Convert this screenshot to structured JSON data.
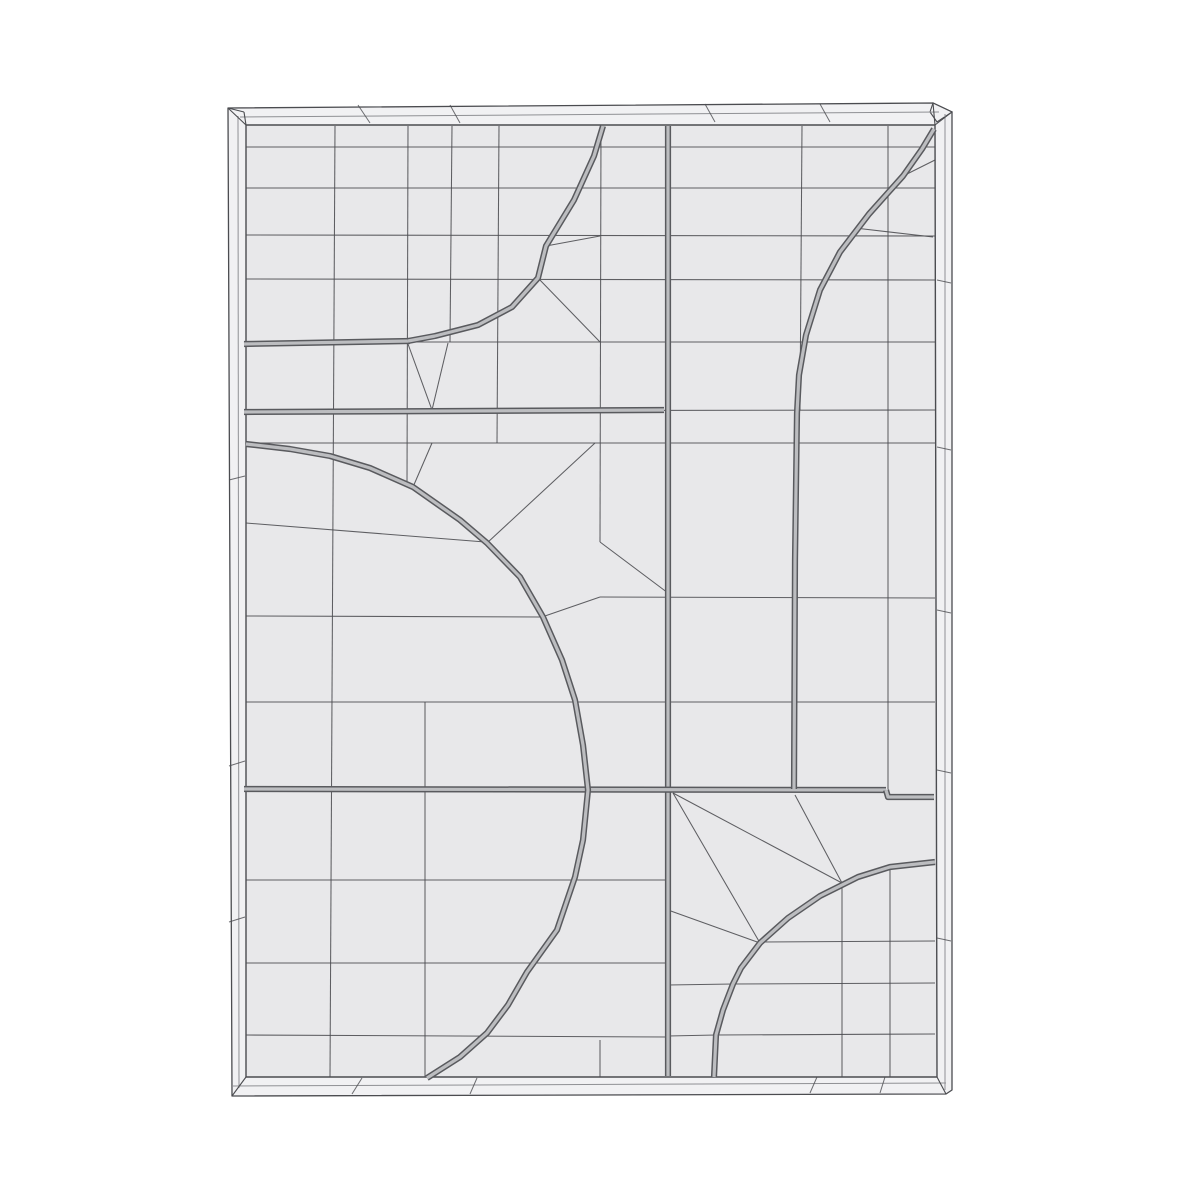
{
  "canvas": {
    "width": 1200,
    "height": 1200,
    "background": "#ffffff"
  },
  "colors": {
    "face_fill": "#e8e8ea",
    "band_fill": "#f1f1f3",
    "line": "#4b4c50",
    "band_line": "#8f9094",
    "groove_dark": "#595a5e",
    "groove_light": "#bcbdc0"
  },
  "panel": {
    "outer_polygon": [
      [
        228,
        108
      ],
      [
        933,
        103
      ],
      [
        952,
        112
      ],
      [
        952,
        1090
      ],
      [
        946,
        1094
      ],
      [
        232,
        1096
      ]
    ],
    "corner_lip": [
      [
        933,
        103
      ],
      [
        952,
        112
      ],
      [
        937,
        122
      ],
      [
        930,
        112
      ]
    ],
    "inner_polygon": [
      [
        246,
        125
      ],
      [
        935,
        125
      ],
      [
        937,
        1077
      ],
      [
        246,
        1077
      ]
    ],
    "band_mid_lines": [
      [
        240,
        117,
        939,
        112
      ],
      [
        238,
        116,
        239,
        1088
      ],
      [
        233,
        1086,
        946,
        1083
      ],
      [
        945,
        114,
        945,
        1090
      ]
    ],
    "corner_bevels": [
      [
        228,
        108,
        246,
        125
      ],
      [
        933,
        103,
        935,
        125
      ],
      [
        952,
        112,
        935,
        125
      ],
      [
        232,
        1096,
        246,
        1077
      ],
      [
        946,
        1094,
        937,
        1077
      ],
      [
        228,
        108,
        244,
        112
      ],
      [
        244,
        112,
        246,
        125
      ]
    ],
    "band_ticks": [
      [
        358,
        105,
        370,
        123
      ],
      [
        450,
        105,
        460,
        123
      ],
      [
        705,
        104,
        715,
        122
      ],
      [
        820,
        104,
        830,
        122
      ],
      [
        362,
        1078,
        352,
        1094
      ],
      [
        477,
        1078,
        470,
        1094
      ],
      [
        817,
        1077,
        810,
        1093
      ],
      [
        885,
        1077,
        880,
        1093
      ],
      [
        229,
        480,
        245,
        476
      ],
      [
        229,
        766,
        245,
        761
      ],
      [
        229,
        922,
        245,
        917
      ],
      [
        937,
        280,
        951,
        283
      ],
      [
        937,
        447,
        951,
        450
      ],
      [
        937,
        610,
        951,
        613
      ],
      [
        937,
        770,
        951,
        773
      ],
      [
        937,
        938,
        951,
        941
      ]
    ]
  },
  "grid_segments": [
    [
      246,
      147,
      935,
      147
    ],
    [
      246,
      188,
      935,
      188
    ],
    [
      246,
      235,
      935,
      236
    ],
    [
      246,
      279,
      935,
      280
    ],
    [
      246,
      342,
      935,
      342
    ],
    [
      246,
      411,
      935,
      410
    ],
    [
      246,
      443,
      935,
      443
    ],
    [
      600,
      597,
      935,
      598
    ],
    [
      246,
      702,
      935,
      702
    ],
    [
      246,
      523,
      485,
      542
    ],
    [
      246,
      616,
      542,
      617
    ],
    [
      246,
      880,
      668,
      880
    ],
    [
      246,
      963,
      668,
      963
    ],
    [
      246,
      1035,
      668,
      1037
    ],
    [
      758,
      942,
      935,
      941
    ],
    [
      733,
      984,
      935,
      983
    ],
    [
      716,
      1035,
      935,
      1034
    ],
    [
      335,
      126,
      330,
      1077
    ],
    [
      408,
      126,
      407,
      485
    ],
    [
      452,
      126,
      450,
      342
    ],
    [
      499,
      126,
      497,
      443
    ],
    [
      601,
      126,
      600,
      542
    ],
    [
      425,
      702,
      425,
      1077
    ],
    [
      802,
      126,
      800,
      410
    ],
    [
      888,
      126,
      888,
      789
    ],
    [
      842,
      883,
      842,
      1077
    ],
    [
      890,
      867,
      890,
      1077
    ],
    [
      600,
      1040,
      600,
      1077
    ],
    [
      408,
      344,
      432,
      410
    ],
    [
      448,
      343,
      432,
      410
    ],
    [
      538,
      278,
      600,
      342
    ],
    [
      546,
      246,
      600,
      236
    ],
    [
      413,
      487,
      432,
      443
    ],
    [
      487,
      543,
      595,
      443
    ],
    [
      542,
      617,
      600,
      597
    ],
    [
      600,
      542,
      668,
      593
    ],
    [
      903,
      176,
      935,
      160
    ],
    [
      855,
      228,
      933,
      237
    ],
    [
      673,
      793,
      842,
      883
    ],
    [
      795,
      795,
      842,
      883
    ],
    [
      673,
      793,
      760,
      943
    ],
    [
      668,
      910,
      760,
      943
    ],
    [
      668,
      985,
      733,
      984
    ],
    [
      668,
      1036,
      716,
      1035
    ]
  ],
  "groove_polylines": [
    [
      [
        668,
        126
      ],
      [
        668,
        1076
      ]
    ],
    [
      [
        244,
        344
      ],
      [
        410,
        341
      ]
    ],
    [
      [
        244,
        412
      ],
      [
        664,
        410
      ]
    ],
    [
      [
        244,
        789
      ],
      [
        886,
        790
      ]
    ],
    [
      [
        886,
        790
      ],
      [
        888,
        797
      ],
      [
        934,
        797
      ]
    ],
    [
      [
        603,
        126
      ],
      [
        594,
        156
      ],
      [
        574,
        200
      ],
      [
        546,
        246
      ],
      [
        538,
        278
      ],
      [
        512,
        307
      ],
      [
        478,
        325
      ],
      [
        435,
        336
      ],
      [
        408,
        341
      ]
    ],
    [
      [
        934,
        129
      ],
      [
        922,
        149
      ],
      [
        903,
        176
      ],
      [
        869,
        214
      ],
      [
        840,
        252
      ],
      [
        820,
        290
      ],
      [
        806,
        335
      ],
      [
        799,
        375
      ],
      [
        797,
        413
      ],
      [
        795,
        560
      ],
      [
        794,
        789
      ]
    ],
    [
      [
        246,
        444
      ],
      [
        290,
        449
      ],
      [
        330,
        456
      ],
      [
        370,
        468
      ],
      [
        413,
        487
      ],
      [
        460,
        520
      ],
      [
        487,
        543
      ],
      [
        520,
        577
      ],
      [
        543,
        617
      ],
      [
        562,
        660
      ],
      [
        575,
        700
      ],
      [
        583,
        745
      ],
      [
        588,
        790
      ],
      [
        583,
        840
      ],
      [
        575,
        877
      ],
      [
        557,
        930
      ],
      [
        527,
        972
      ],
      [
        508,
        1005
      ],
      [
        487,
        1033
      ],
      [
        460,
        1057
      ],
      [
        427,
        1078
      ]
    ],
    [
      [
        935,
        862
      ],
      [
        890,
        867
      ],
      [
        858,
        877
      ],
      [
        820,
        896
      ],
      [
        788,
        918
      ],
      [
        760,
        943
      ],
      [
        741,
        968
      ],
      [
        733,
        984
      ],
      [
        723,
        1010
      ],
      [
        716,
        1035
      ],
      [
        714,
        1077
      ]
    ]
  ]
}
